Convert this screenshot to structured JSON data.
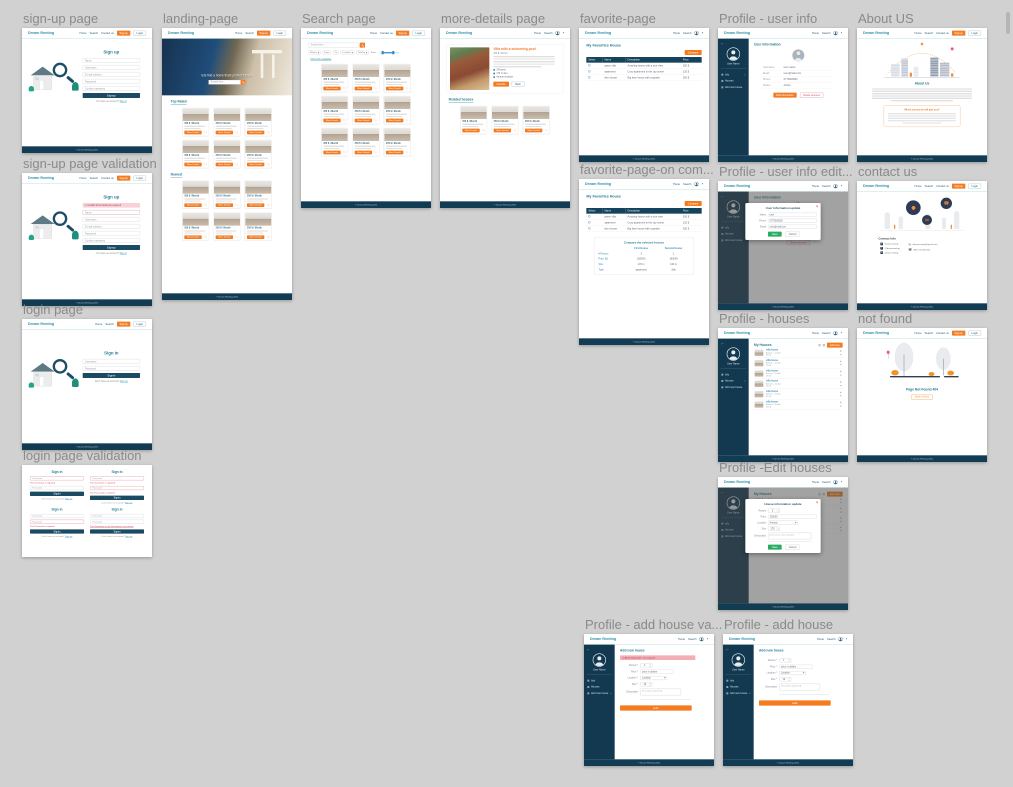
{
  "canvas": {
    "background": "#d1d1d1"
  },
  "colors": {
    "accent_orange": "#f47b20",
    "navy": "#123c53",
    "teal_brand": "#2b8fa8",
    "heading_teal": "#267d92",
    "green": "#27ae60",
    "error_red": "#cc3b4d"
  },
  "shared": {
    "logo": "Dream Renting",
    "nav": {
      "home": "Home",
      "search": "Search",
      "contact": "Contact us"
    },
    "signup_btn": "Signup",
    "login_btn": "Login",
    "footer": "© Dream Renting 2021",
    "caret": "▾",
    "caret_up": "▴",
    "chevron": "›"
  },
  "card": {
    "price": "250 $ / Month",
    "details_btn": "More Details",
    "fav_icon": "♡"
  },
  "sidebar": {
    "back": "←",
    "username": "User Name",
    "items": [
      {
        "label": "Info"
      },
      {
        "label": "Houses"
      },
      {
        "label": "Add new house"
      }
    ]
  },
  "frames": {
    "signup": {
      "title": "sign-up page",
      "heading": "Sign up",
      "fields": [
        "Name",
        "Username",
        "E-mail address",
        "Password",
        "Confirm password"
      ],
      "submit": "Signup",
      "alt_text": "You have an account?",
      "alt_link": "Sign in"
    },
    "signup_validation": {
      "title": "sign-up page validation",
      "error": "⚠ Invalid! all the fields are required"
    },
    "login": {
      "title": "login page",
      "heading": "Sign in",
      "fields": [
        "Username",
        "Password"
      ],
      "submit": "Signin",
      "alt_text": "Don't have an account?",
      "alt_link": "Sign up"
    },
    "login_validation": {
      "title": "login page validation",
      "error_username": "The Username is required",
      "error_password": "The Password is required",
      "error_wrong": "The Username or the Password is not correct"
    },
    "landing": {
      "title": "landing-page",
      "hero_caption": "lets find a home thats perfect for you",
      "hero_placeholder": "Search here ...",
      "section_top": "Top Rated",
      "section_new": "Newest"
    },
    "search": {
      "title": "Search page",
      "placeholder": "Search here ...",
      "filters": {
        "rooms": "Rooms",
        "from": "From",
        "to": "To",
        "location": "Location",
        "sort": "Sort by",
        "price": "Price"
      },
      "results": "9 Results available"
    },
    "details": {
      "title": "more-details page",
      "house_title": "Villa with a swimming pool",
      "price": "250 $ / Month",
      "features": [
        "3 Rooms",
        "170 m size",
        "Amman location"
      ],
      "favorite_btn": "Favorite",
      "back_btn": "Back",
      "related": "Related houses"
    },
    "favorite": {
      "title": "favorite-page",
      "heading": "My Favorites House",
      "compare_btn": "Compare",
      "headers": [
        "Select",
        "Name",
        "Description",
        "Price"
      ],
      "rows": [
        {
          "name": "green villa",
          "desc": "Amazing house with a nice view",
          "price": "250 $"
        },
        {
          "name": "apartment",
          "desc": "Cozy apartment in the city center",
          "price": "120 $"
        },
        {
          "name": "farm house",
          "desc": "Big farm house with a garden",
          "price": "300 $"
        }
      ]
    },
    "favorite_compare": {
      "title": "favorite-page-on com...",
      "heading": "Compare the selected houses",
      "col1": "First House",
      "col2": "Second House",
      "rows": [
        {
          "label": "# Rooms",
          "a": "3",
          "b": "2"
        },
        {
          "label": "Price ($)",
          "a": "250000",
          "b": "190000"
        },
        {
          "label": "Size",
          "a": "170 m",
          "b": "140 m"
        },
        {
          "label": "Type",
          "a": "apartment",
          "b": "villa"
        }
      ]
    },
    "profile_info": {
      "title": "Profile - user info",
      "heading": "User Information",
      "rows": [
        {
          "label": "Username",
          "value": "user name"
        },
        {
          "label": "Email",
          "value": "user@mail.com"
        },
        {
          "label": "Phone",
          "value": "0770000000"
        },
        {
          "label": "Status",
          "value": "Active"
        }
      ],
      "edit_btn": "Edit information",
      "delete_btn": "Delete account"
    },
    "profile_info_edit": {
      "title": "Profile - user info edit...",
      "modal_heading": "User Information update",
      "close": "×",
      "fields": [
        {
          "label": "Name",
          "value": "user"
        },
        {
          "label": "Phone",
          "value": "0770000000"
        },
        {
          "label": "Email",
          "value": "user@mail.com"
        }
      ],
      "save_btn": "Save",
      "cancel_btn": "Cancel"
    },
    "profile_houses": {
      "title": "Profile - houses",
      "heading": "My Houses",
      "add_btn": "Add new",
      "row": {
        "name": "villa house",
        "loc": "Amman - Jordan",
        "price": "250 $"
      },
      "edit_icon": "✎",
      "delete_icon": "×"
    },
    "profile_edit_house": {
      "title": "Profile -Edit houses",
      "modal_heading": "House information update",
      "close": "×",
      "rooms_label": "Rooms",
      "rooms_value": "3",
      "price_label": "Price",
      "price_value": "250000",
      "location_label": "Location",
      "location_value": "Amman",
      "size_label": "Size",
      "size_value": "170",
      "desc_label": "Description",
      "desc_value": "Nice house with a garden",
      "save_btn": "Save",
      "cancel_btn": "Cancel"
    },
    "about": {
      "title": "About US",
      "heading": "About Us",
      "box_heading": "Which service we will give you?"
    },
    "contact": {
      "title": "contact us",
      "heading": "Contact Info",
      "left": [
        {
          "icon": "G",
          "value": "dream-renting"
        },
        {
          "icon": "T",
          "value": "@dreamrenting"
        },
        {
          "icon": "in",
          "value": "dream renting"
        }
      ],
      "right": [
        {
          "glyph": "✉",
          "value": "dreamrenting@gmail.com"
        },
        {
          "glyph": "☎",
          "value": "+962 770 000 000"
        }
      ]
    },
    "notfound": {
      "title": "not found",
      "message": "Page Not Found 404",
      "back_btn": "back to home"
    },
    "add_house_validation": {
      "title": "Profile - add house va...",
      "error": "⚠ All the fields with * are required!"
    },
    "add_house": {
      "title": "Profile - add house",
      "heading": "Add new house",
      "rooms_label": "Rooms *",
      "rooms_value": "1",
      "price_label": "Price *",
      "price_placeholder": "price in dollars",
      "location_label": "Location *",
      "location_value": "Location",
      "size_label": "Size *",
      "size_value": "10",
      "desc_label": "Description",
      "desc_placeholder": "description (optional)",
      "add_btn": "Add"
    }
  }
}
